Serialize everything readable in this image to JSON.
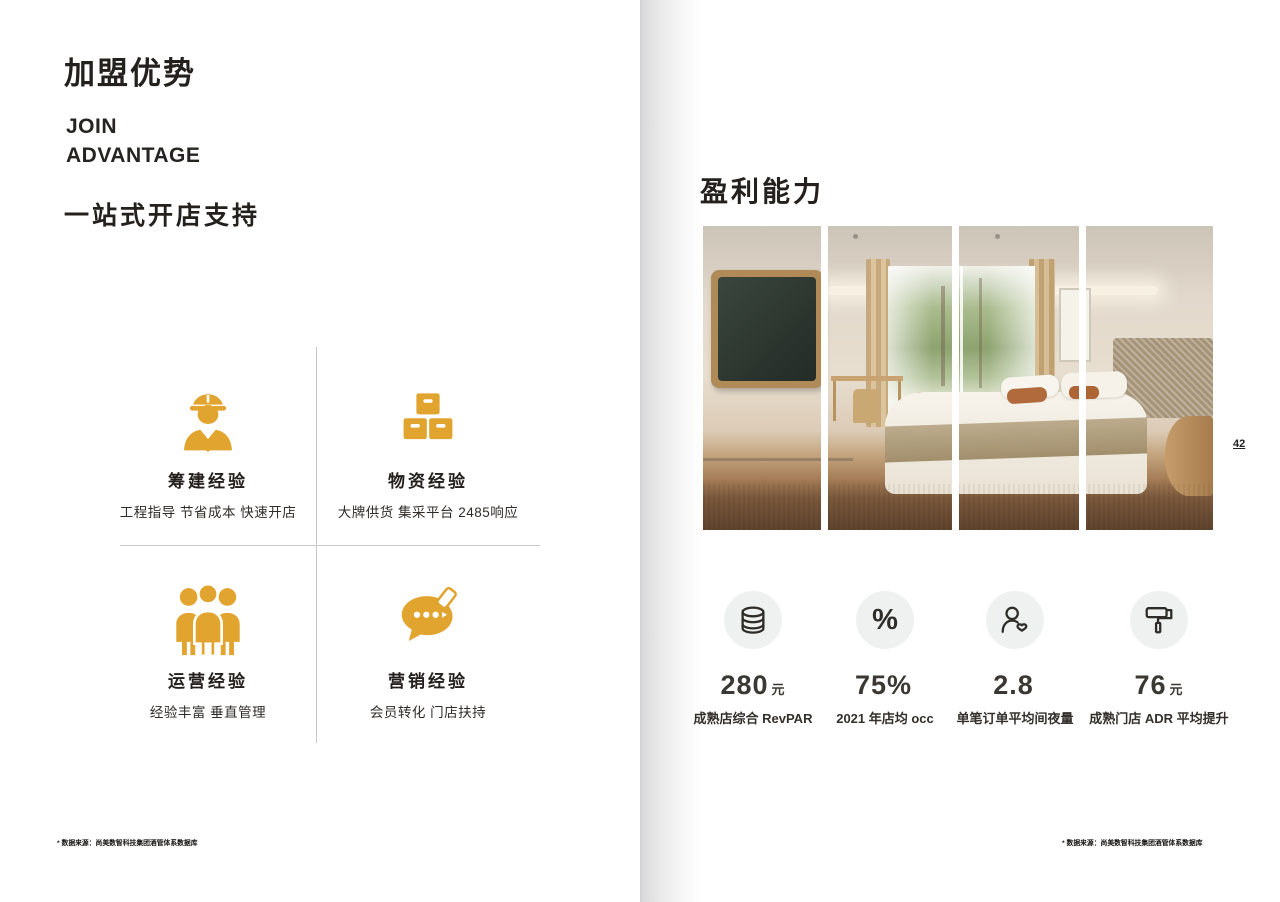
{
  "left_page": {
    "title": "加盟优势",
    "en_line1": "JOIN",
    "en_line2": "ADVANTAGE",
    "section_title": "一站式开店支持",
    "quadrants": [
      {
        "icon": "engineer-icon",
        "title": "筹建经验",
        "desc": "工程指导 节省成本 快速开店"
      },
      {
        "icon": "boxes-icon",
        "title": "物资经验",
        "desc": "大牌供货 集采平台 2485响应"
      },
      {
        "icon": "team-icon",
        "title": "运营经验",
        "desc": "经验丰富 垂直管理"
      },
      {
        "icon": "chat-marketing-icon",
        "title": "营销经验",
        "desc": "会员转化 门店扶持"
      }
    ],
    "footnote": "* 数据来源：尚美数智科技集团酒管体系数据库"
  },
  "right_page": {
    "title": "盈利能力",
    "page_number": "42",
    "photo_description": "hotel-guest-room-four-panel-photo",
    "stats": [
      {
        "icon": "coins-icon",
        "value": "280",
        "unit": "元",
        "label": "成熟店综合 RevPAR"
      },
      {
        "icon": "percent-icon",
        "value": "75%",
        "unit": "",
        "label": "2021 年店均 occ"
      },
      {
        "icon": "guest-heart-icon",
        "value": "2.8",
        "unit": "",
        "label": "单笔订单平均间夜量"
      },
      {
        "icon": "paint-roller-icon",
        "value": "76",
        "unit": "元",
        "label": "成熟门店 ADR 平均提升"
      }
    ],
    "footnote": "* 数据来源：尚美数智科技集团酒管体系数据库"
  },
  "colors": {
    "accent_gold": "#E1A42F",
    "text_dark": "#23201d",
    "stat_circle_bg": "#EEF1F0"
  }
}
